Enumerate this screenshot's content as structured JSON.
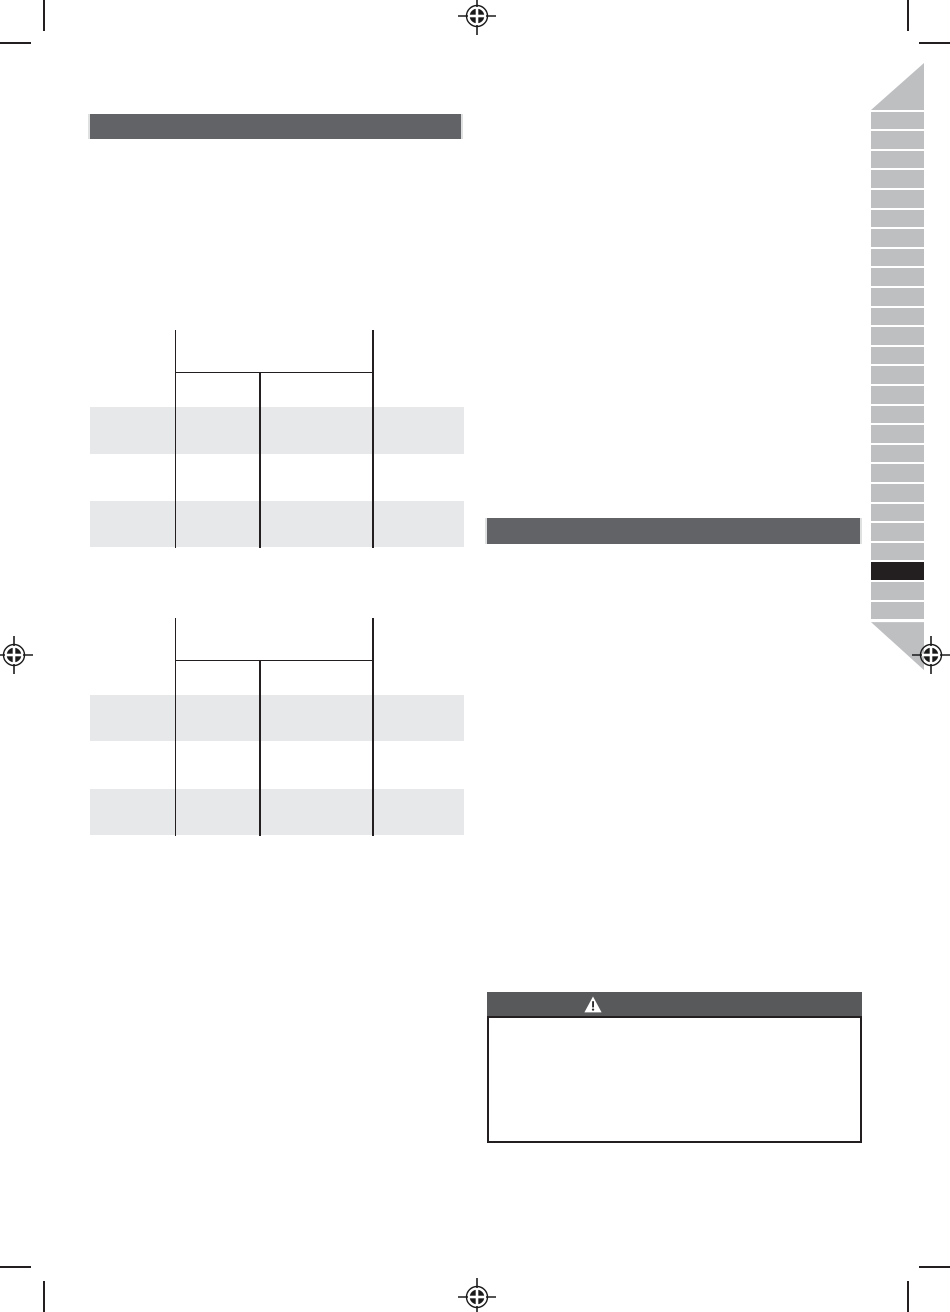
{
  "document": {
    "kind": "print-manual-page",
    "visible_text": ""
  },
  "colors": {
    "section_bar": "#626366",
    "warning_bar": "#58595b",
    "table_stripe": "#e7e8e9",
    "rule_line": "#231f20",
    "tab_gray": "#bdbfc1",
    "tab_active": "#231f20",
    "reg_mark": "#1a1a1a",
    "crop_mark": "#231f20",
    "bar_end_cap": "#dfe1e0",
    "page_bg": "#ffffff"
  },
  "left_column": {
    "section_header": {
      "label": ""
    },
    "tables": [
      {
        "name": "spec-table-1",
        "column_count": 3,
        "striped_row_count": 2,
        "header_row_label": "",
        "cell_text": ""
      },
      {
        "name": "spec-table-2",
        "column_count": 3,
        "striped_row_count": 2,
        "header_row_label": "",
        "cell_text": ""
      }
    ]
  },
  "right_column": {
    "section_header": {
      "label": ""
    },
    "warning_box": {
      "title": "",
      "icon": "warning-triangle-icon",
      "body_text": ""
    }
  },
  "tab_strip": {
    "tab_count": 26,
    "active_tab_index": 23
  },
  "print_marks": {
    "registration_marks": 4,
    "corner_crop_marks": 4
  }
}
